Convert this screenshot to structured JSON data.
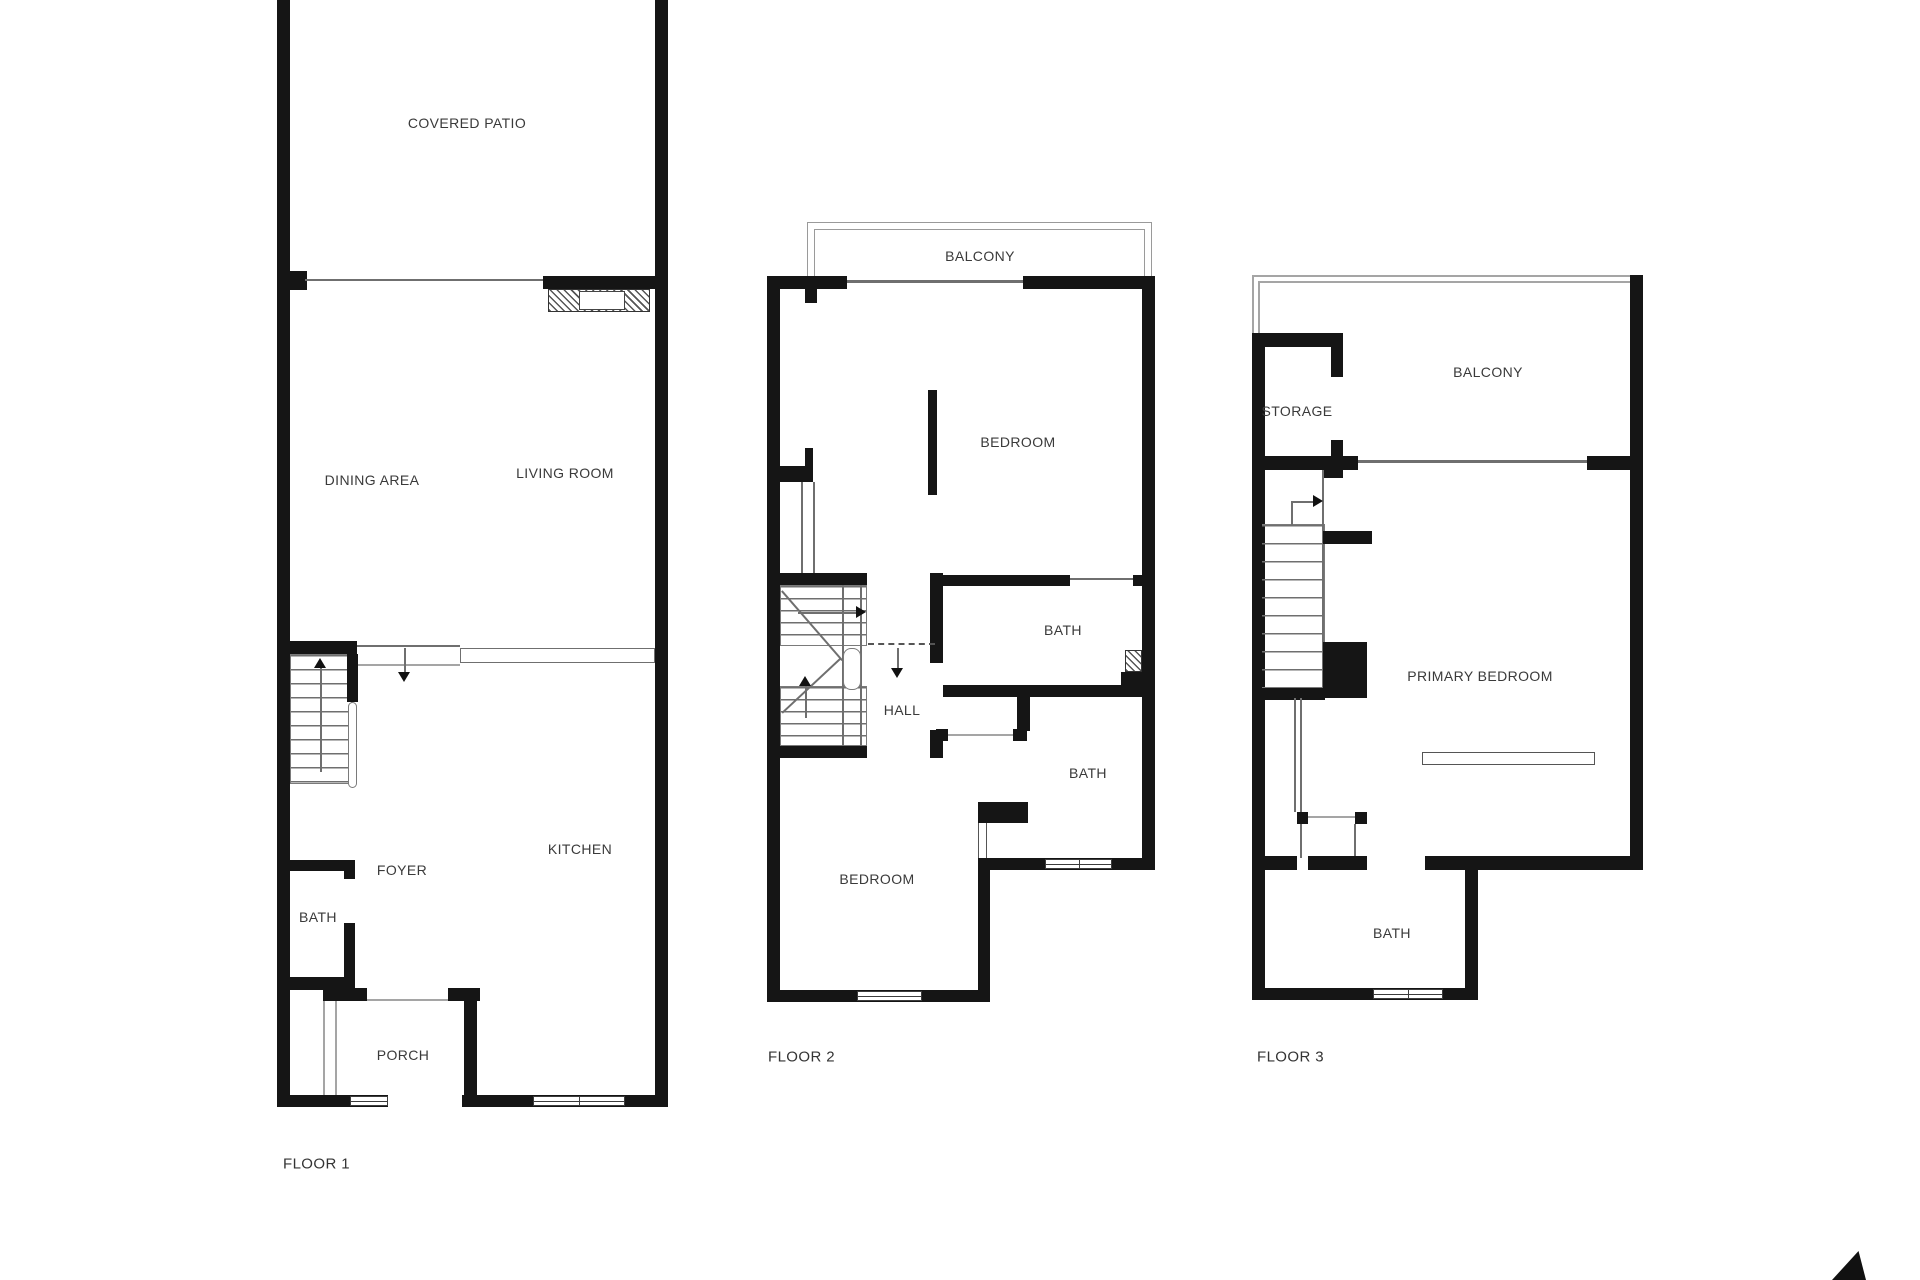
{
  "floors": [
    {
      "caption": "FLOOR 1",
      "rooms": [
        "COVERED PATIO",
        "DINING AREA",
        "LIVING ROOM",
        "FOYER",
        "BATH",
        "KITCHEN",
        "PORCH"
      ]
    },
    {
      "caption": "FLOOR 2",
      "rooms": [
        "BALCONY",
        "BEDROOM",
        "BATH",
        "HALL",
        "BATH",
        "BEDROOM"
      ]
    },
    {
      "caption": "FLOOR 3",
      "rooms": [
        "BALCONY",
        "STORAGE",
        "PRIMARY BEDROOM",
        "BATH"
      ]
    }
  ],
  "icons": {
    "north_arrow": "▲"
  },
  "colors": {
    "wall": "#151515",
    "thin_line": "#6f6f6f",
    "label_text": "#3a3a3a",
    "background": "#ffffff"
  }
}
